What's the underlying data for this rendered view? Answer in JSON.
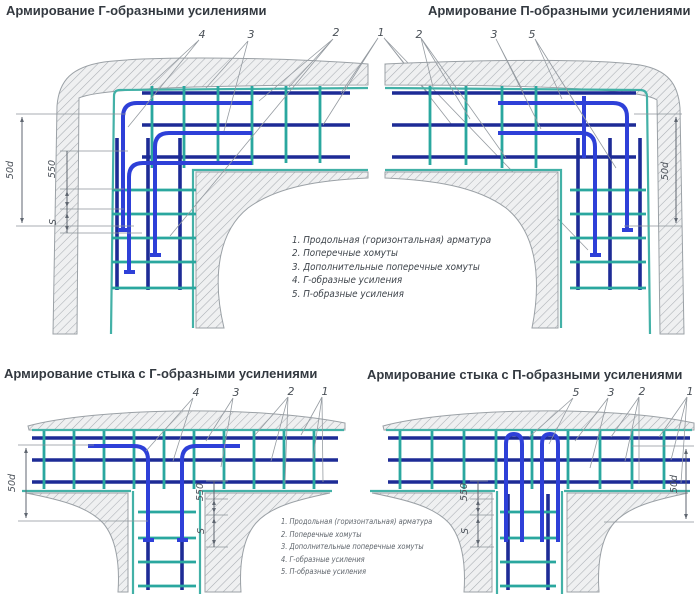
{
  "titles": {
    "top_left": "Армирование Г-образными усилениями",
    "top_right": "Армирование П-образными усилениями",
    "bottom_left": "Армирование стыка с Г-образными усилениями",
    "bottom_right": "Армирование стыка с П-образными усилениями"
  },
  "legend_items": [
    "1. Продольная (горизонтальная) арматура",
    "2. Поперечные хомуты",
    "3. Дополнительные поперечные хомуты",
    "4. Г-образные усиления",
    "5. П-образные усиления"
  ],
  "callouts": {
    "n1": "1",
    "n2": "2",
    "n3": "3",
    "n4": "4",
    "n5": "5"
  },
  "dims": {
    "anchorage": "50d",
    "zone": "550",
    "spacing": "S"
  },
  "colors": {
    "rebar_longitudinal": "#1d2b96",
    "rebar_reinforcement": "#2e40d8",
    "ties": "#2aa79f",
    "wall_face_line": "#43b1a7",
    "concrete_hatch": "#a9aeb3"
  }
}
